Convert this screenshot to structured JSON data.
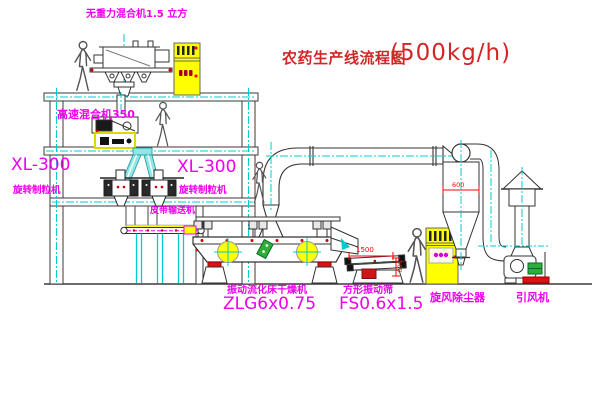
{
  "title": {
    "text": "农药生产线流程图",
    "capacity": "(500kg/h)"
  },
  "labels": {
    "gravity_mixer": "无重力混合机1.5 立方",
    "high_speed_mixer": "高速混合机350",
    "granulator_left_model": "XL-300",
    "granulator_left_name": "旋转制粒机",
    "granulator_mid_model": "XL-300",
    "granulator_mid_name": "旋转制粒机",
    "belt_conveyor": "皮带输送机",
    "dryer_name": "振动流化床干燥机",
    "dryer_model": "ZLG6x0.75",
    "sieve_name": "方形振动筛",
    "sieve_model": "FS0.6x1.5",
    "cyclone_name": "旋风除尘器",
    "fan_name": "引风机"
  },
  "dimensions": {
    "cyclone_diameter": "600",
    "sieve_length": "1500",
    "sieve_height": "500"
  },
  "colors": {
    "label_magenta": "#ee00ee",
    "title_red": "#d42626",
    "dimension_red": "#ff0000",
    "centerline_cyan": "#00cccc",
    "equipment_yellow": "#ffff00",
    "motor_green": "#2fae3a",
    "base_red": "#dd1111"
  }
}
